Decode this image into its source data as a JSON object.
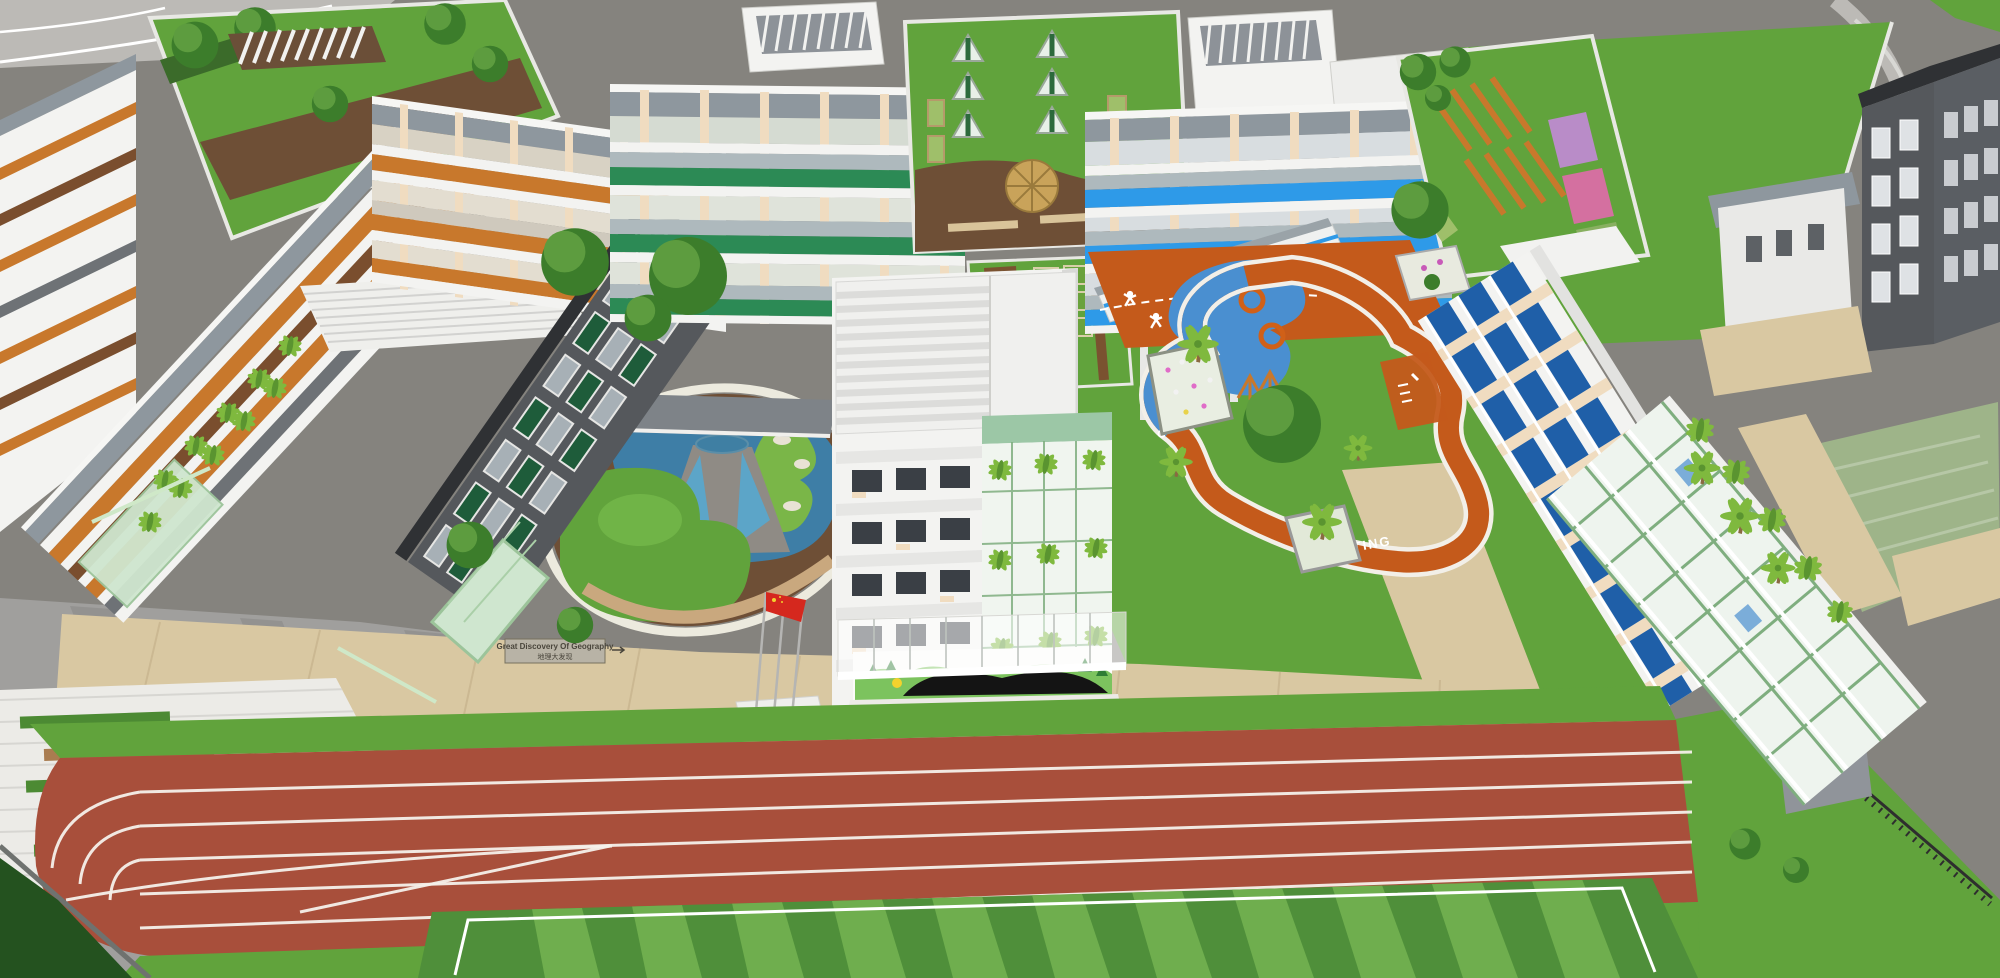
{
  "scene": {
    "kind": "3d-aerial-architectural-rendering",
    "subject_features": [
      "school-campus",
      "running-track",
      "soccer-field",
      "children-playground",
      "geography-pond-garden",
      "rooftop-farm",
      "rooftop-pergola-garden",
      "rooftop-umbrella-terrace",
      "entrance-canopy-with-book-mural",
      "flag-poles",
      "vertical-garden-facades",
      "guard-house",
      "perimeter-roads"
    ],
    "counts": {
      "flagpoles": 3,
      "flags": 1,
      "track_lanes": 6
    }
  },
  "labels": {
    "geography_sign_line1": "Great Discovery Of Geography",
    "geography_sign_line2": "地理大发现",
    "playground_path": "CHILDREN ST",
    "track_start": "STARTING"
  },
  "palette": {
    "road": "#85837e",
    "roadLight": "#bcbab6",
    "lawn": "#61a33c",
    "lawnDark": "#4c8a33",
    "fieldLight": "#6fae4e",
    "fieldDark": "#4f8f3a",
    "track": "#a84f3b",
    "plazaBeige": "#d9c8a2",
    "plazaGray": "#a09f9d",
    "deckBrown": "#6e4f36",
    "deckLight": "#c9a87e",
    "buildingWhite": "#f3f3f1",
    "buildingShadow": "#d9d9d7",
    "roofGray": "#8e979e",
    "darkFacade": "#55585c",
    "darkRoof": "#2f3134",
    "bandOrange": "#c8782c",
    "bandGreen": "#2c8a55",
    "bandBlue": "#2e9ae8",
    "steelBand": "#aeb9bd",
    "windowDark": "#3a3f45",
    "windowBlue": "#1f5fa8",
    "pond": "#3e7ea6",
    "playOrange": "#c45a1b",
    "playBlue": "#4a8fd0",
    "flagRed": "#d5281e",
    "muralGreen": "#7cc35e",
    "sunYellow": "#f2d22e",
    "cream": "#f0dcc0",
    "palmGreen": "#7fb93e",
    "treeGreen": "#3c7d2b",
    "glassGreen": "#cfe6cf",
    "soil": "#7a5230"
  }
}
